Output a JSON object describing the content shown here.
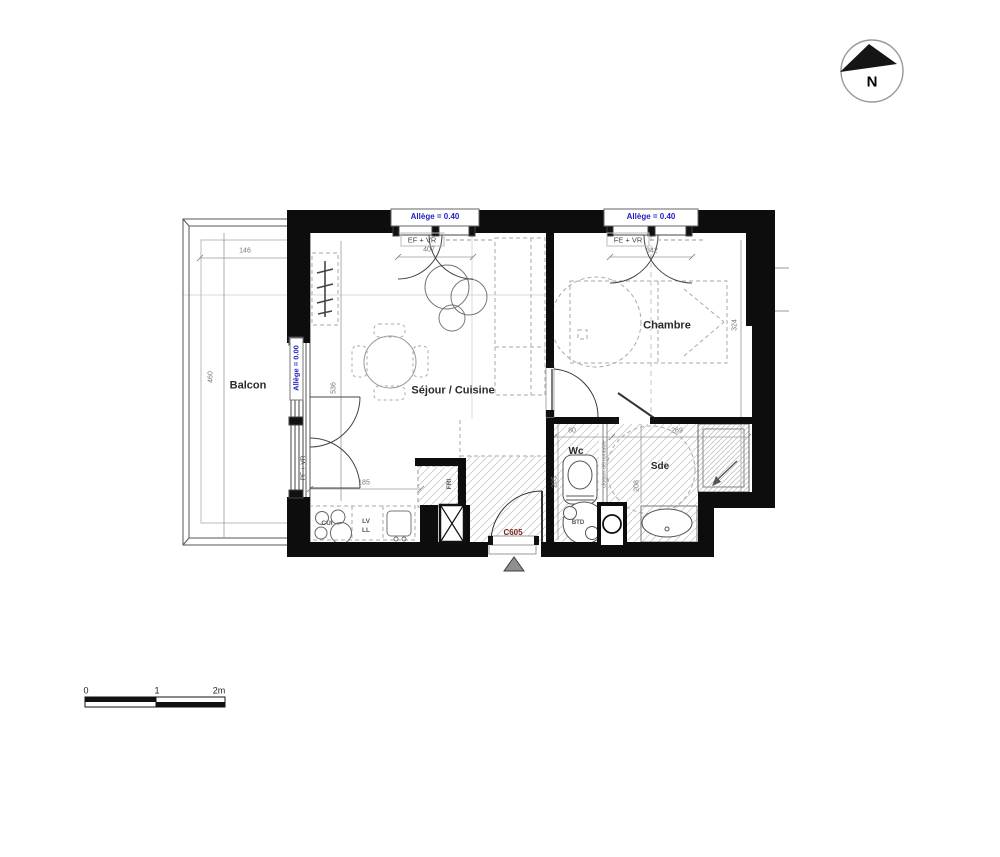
{
  "compass": {
    "label": "N"
  },
  "rooms": {
    "balcon": "Balcon",
    "sejour": "Séjour / Cuisine",
    "chambre": "Chambre",
    "wc": "Wc",
    "sde": "Sde"
  },
  "openings": {
    "window1": {
      "allege": "Allège = 0.40",
      "type": "EF + VR",
      "width": "407"
    },
    "window2": {
      "allege": "Allège = 0.40",
      "type": "FE + VR",
      "width": "342"
    },
    "balcony_door": {
      "allege": "Allège = 0.00",
      "type": "PF + VR"
    },
    "entry_door": {
      "code": "C605"
    }
  },
  "dimensions": {
    "balcon_width": "146",
    "balcon_length": "460",
    "sejour_depth": "536",
    "kitchen_front": "185",
    "chambre_depth": "324",
    "wc_width": "80",
    "sde_width": "269",
    "wc_depth": "205",
    "sde_depth": "208"
  },
  "equipment": {
    "fridge": "FRI",
    "hob": "CUI",
    "dishwasher": "LV",
    "washer": "LL",
    "water_heater": "BTD",
    "partition": "cloison démontable"
  },
  "scale_bar": {
    "t0": "0",
    "t1": "1",
    "t2": "2m"
  },
  "colors": {
    "wall": "#0d0d0d",
    "accent_blue": "#1f1fbf",
    "door_code_red": "#7b241c",
    "hatch": "#cccccc"
  }
}
